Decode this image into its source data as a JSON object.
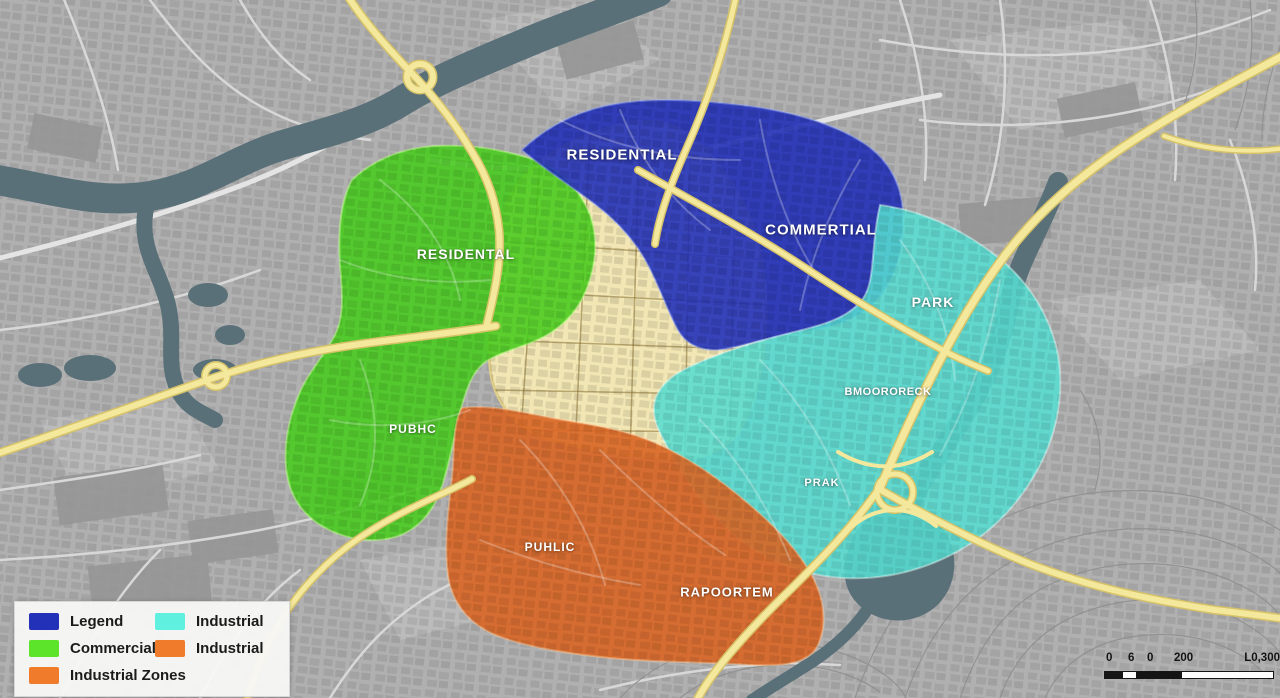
{
  "map": {
    "labels": {
      "residential": "RESIDENTIAL",
      "commertial": "COMMERTIAL",
      "residental": "RESIDENTAL",
      "park": "PARK",
      "bmoororeck": "BMOORORECK",
      "prak": "PRAK",
      "pubhc": "PUBHC",
      "puhlic": "PUHLIC",
      "rapoortem": "RAPOORTEM"
    },
    "zone_colors": {
      "residential_blue": "#2231b8",
      "commercial_green": "#47cc1d",
      "park_cyan": "#57dcd0",
      "industrial_orange": "#d96524",
      "downtown_yellow": "#f2e7b4",
      "highway_yellow": "#f4e89c",
      "water": "#5a7078"
    }
  },
  "legend": {
    "items": [
      {
        "label": "Legend",
        "color": "#2231b8"
      },
      {
        "label": "Industrial",
        "color": "#5ff0df"
      },
      {
        "label": "Commercial",
        "color": "#5ce42a"
      },
      {
        "label": "Industrial",
        "color": "#f07c2b"
      },
      {
        "label": "Industrial Zones",
        "color": "#f07c2b"
      }
    ]
  },
  "scale_bar": {
    "labels": [
      "0",
      "6",
      "0",
      "200",
      "L0,300"
    ]
  }
}
